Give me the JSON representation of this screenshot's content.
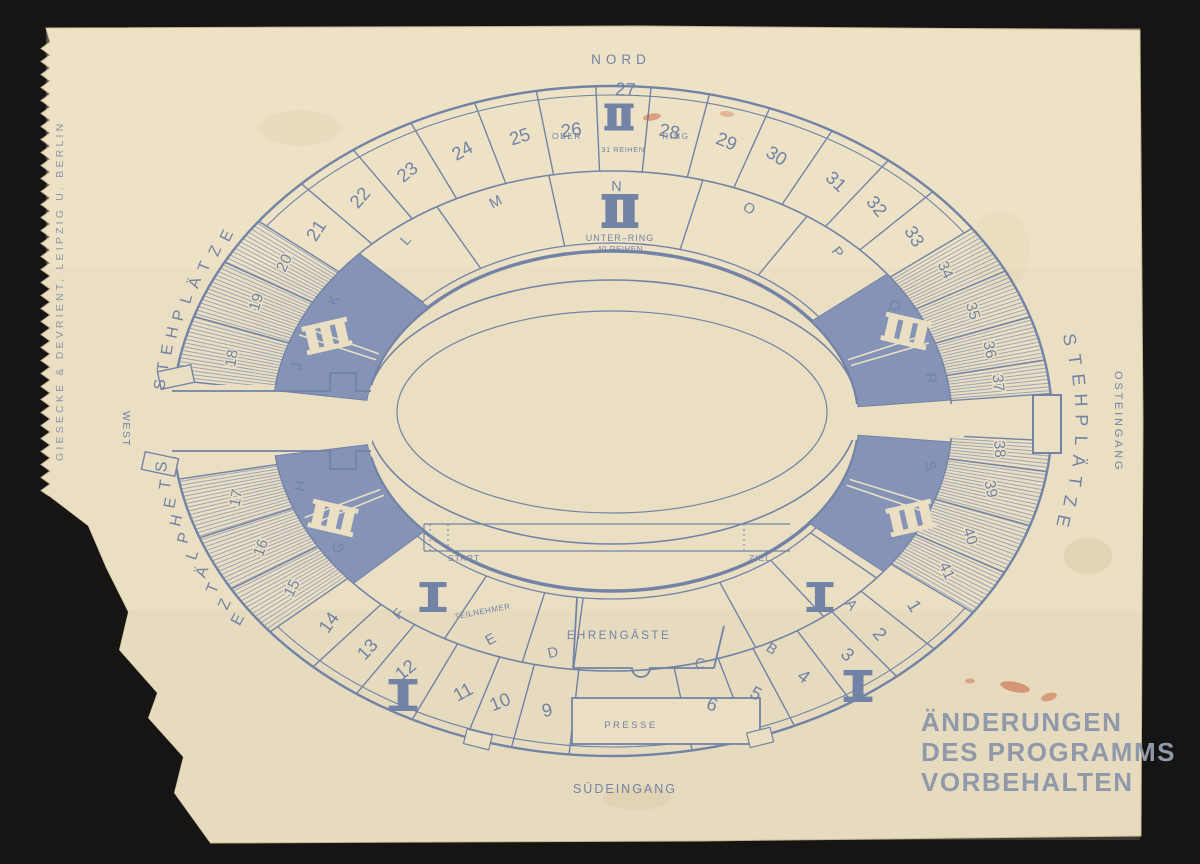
{
  "colors": {
    "background": "#161513",
    "paper": "#eadfc3",
    "ink": "#7283a5",
    "wedge_fill": "#8593b7",
    "hatch": "#8492b2",
    "notice_text": "#8f99aa",
    "stamp": "#c2522c"
  },
  "edge_imprint": "GIESECKE & DEVRIENT, LEIPZIG U. BERLIN",
  "program_notice": {
    "line1": "ÄNDERUNGEN",
    "line2": "DES PROGRAMMS",
    "line3": "VORBEHALTEN"
  },
  "compass": {
    "north": "NORD",
    "west": "WEST",
    "east_entrance": "OSTEINGANG",
    "south_entrance": "SÜDEINGANG"
  },
  "standing_room": {
    "upper_left": "STEHPLÄTZE",
    "lower_left": "STEHPLÄTZE",
    "east": "STEHPLÄTZE"
  },
  "rings": {
    "ober_ring": {
      "numeral": "II",
      "word_left": "OBER",
      "word_right": "RING",
      "rows": "31 REIHEN"
    },
    "unter_ring": {
      "numeral": "II",
      "name": "UNTER–RING",
      "rows": "40 REIHEN"
    },
    "standing_blocks_numeral": "III",
    "lower_blocks_numeral": "I"
  },
  "field": {
    "start_label": "START",
    "finish_label": "ZIEL"
  },
  "areas": {
    "participants": "TEILNEHMER",
    "guests_of_honor": "EHRENGÄSTE",
    "press": "PRESSE"
  },
  "outer_sections": {
    "numbers": [
      "1",
      "2",
      "3",
      "4",
      "5",
      "6",
      "9",
      "10",
      "11",
      "12",
      "13",
      "14",
      "15",
      "16",
      "17",
      "18",
      "19",
      "20",
      "21",
      "22",
      "23",
      "24",
      "25",
      "26",
      "27",
      "28",
      "29",
      "30",
      "31",
      "32",
      "33",
      "34",
      "35",
      "36",
      "37",
      "38",
      "39",
      "40",
      "41"
    ]
  },
  "inner_sections": {
    "letters": [
      "A",
      "B",
      "C",
      "D",
      "E",
      "F",
      "G",
      "H",
      "J",
      "K",
      "L",
      "M",
      "N",
      "O",
      "P",
      "Q",
      "R",
      "S",
      "T"
    ]
  }
}
